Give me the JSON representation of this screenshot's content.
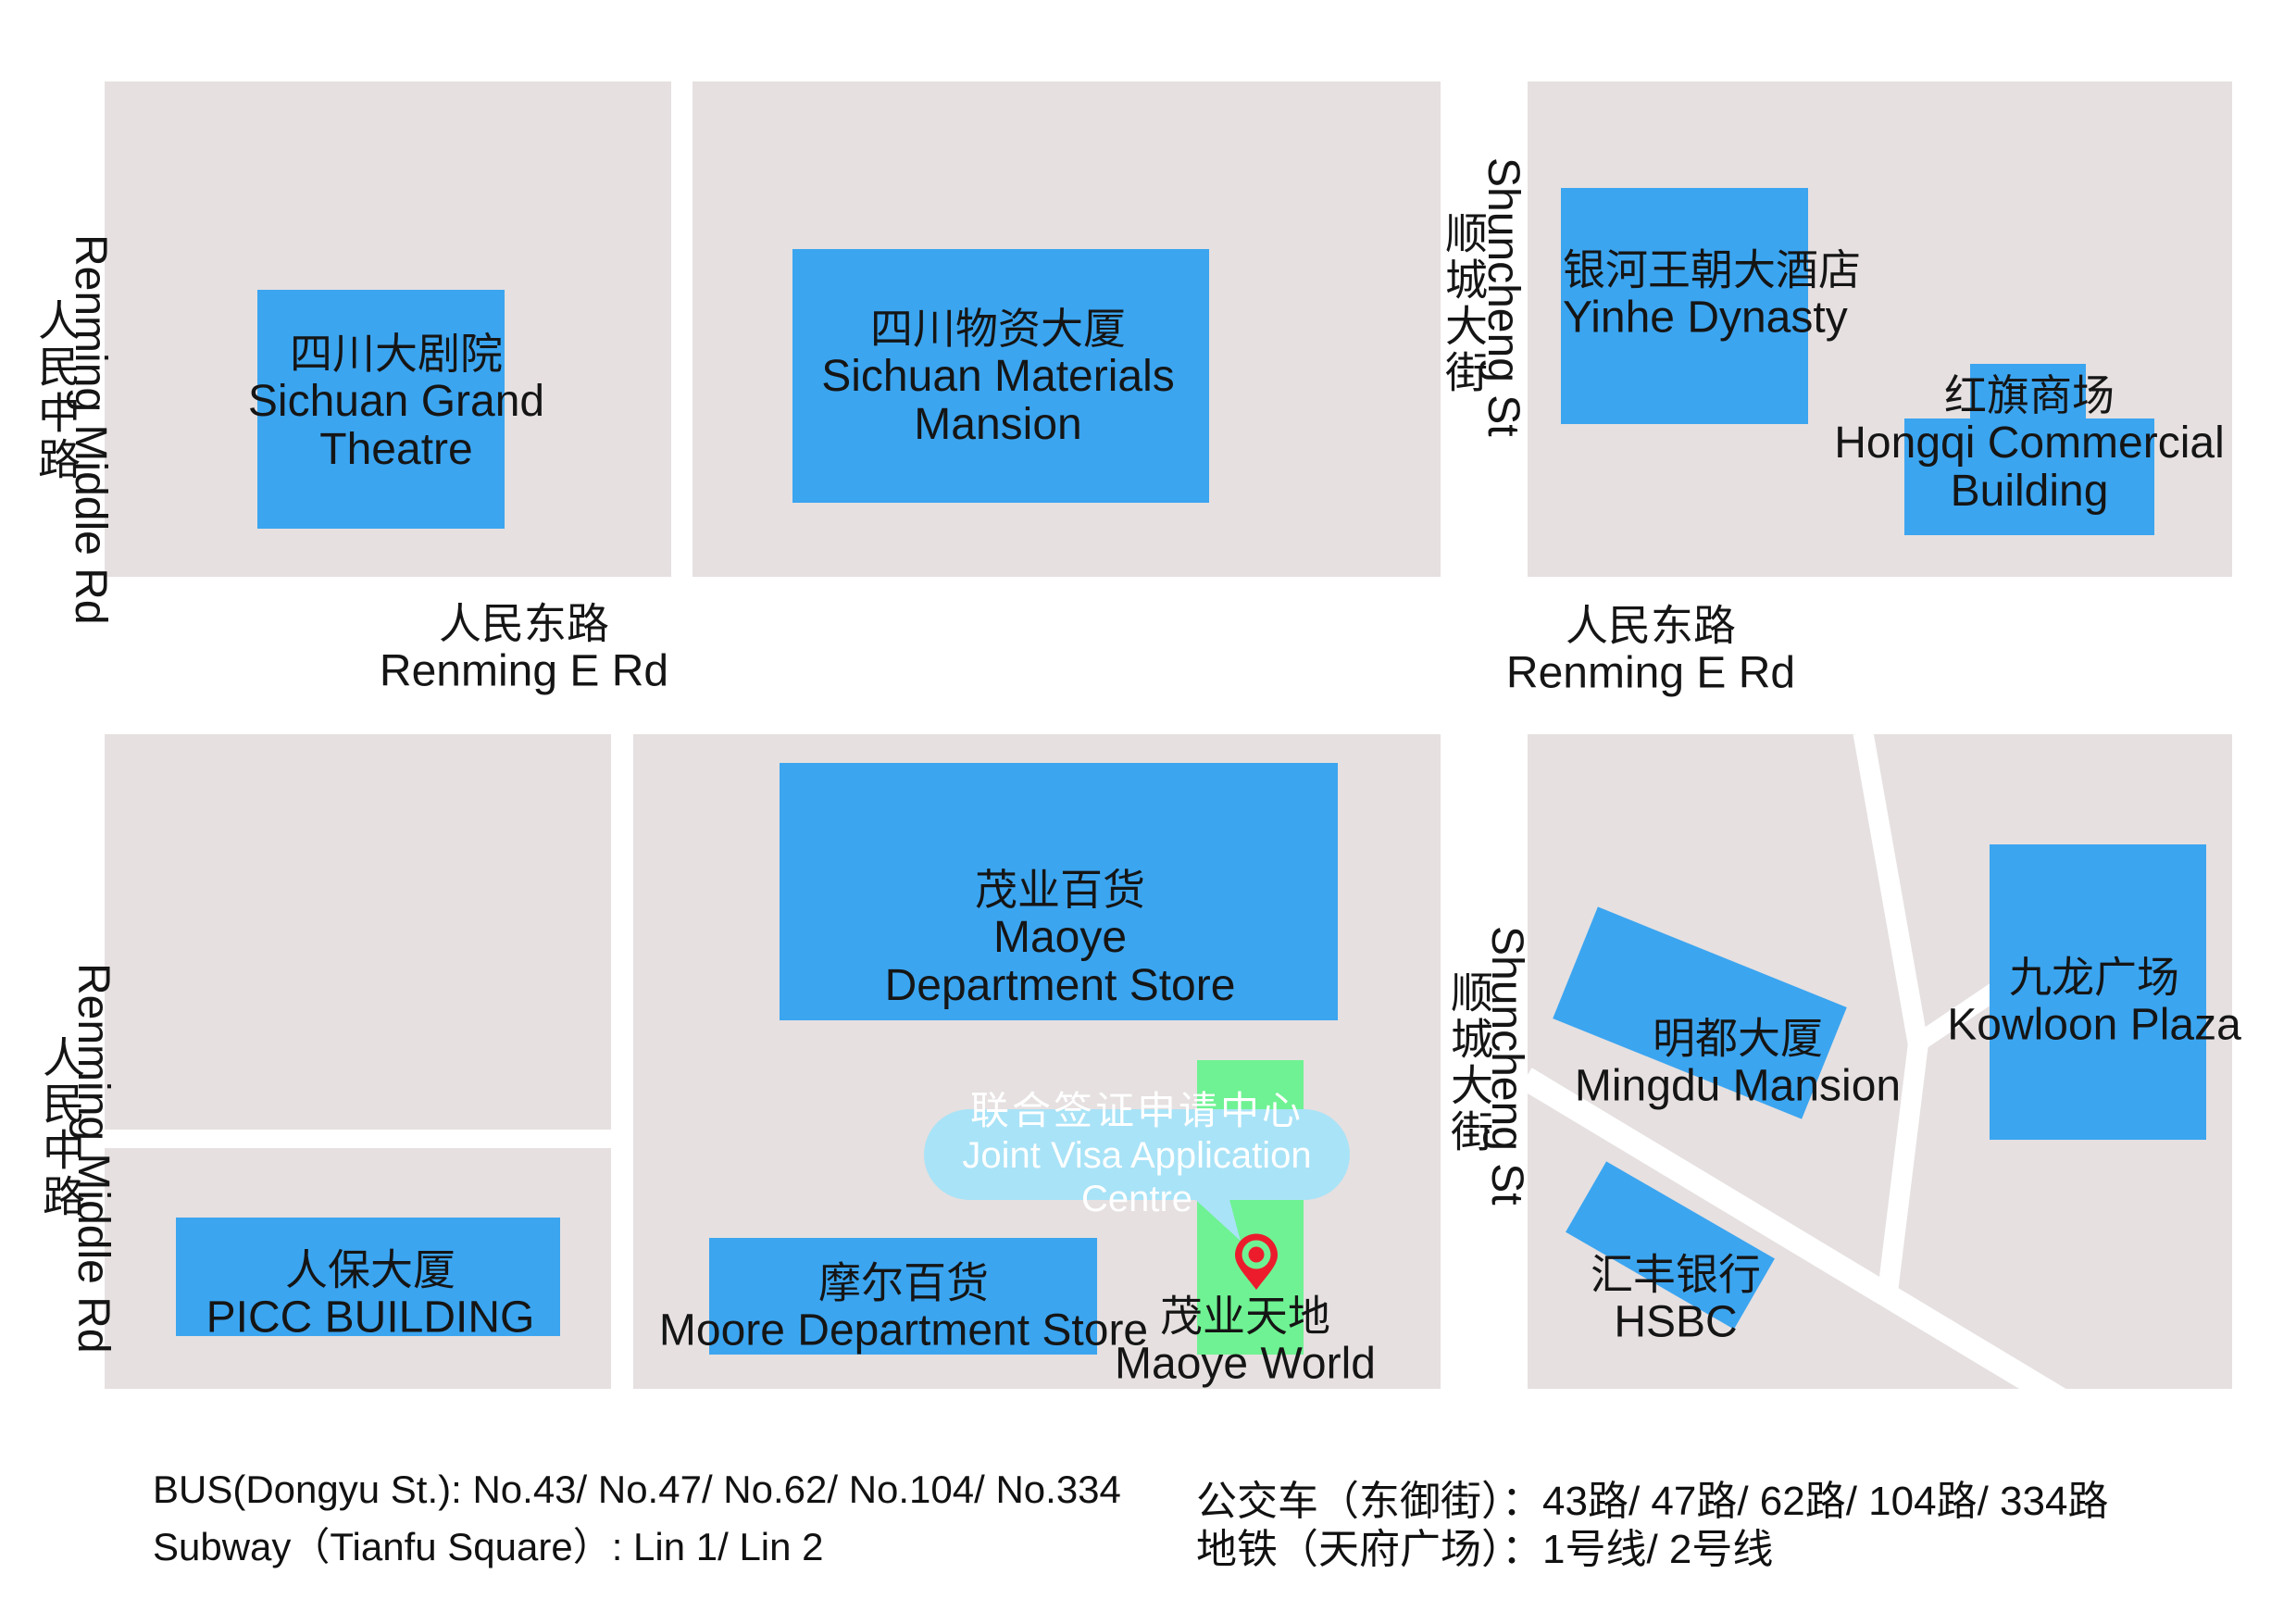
{
  "colors": {
    "building_blue": "#3ba5f0",
    "block_grey": "#e6e0e0",
    "strip_green": "#6ff293",
    "callout_blue": "#a9e3f7",
    "pin_red": "#ec1c2d",
    "road_white": "#ffffff",
    "text_black": "#151515",
    "callout_text": "#ffffff"
  },
  "roads": {
    "renming_middle": {
      "zh": "人民中路",
      "en": "Renming Middle Rd"
    },
    "renming_e": {
      "zh": "人民东路",
      "en": "Renming E Rd"
    },
    "shuncheng": {
      "zh": "顺城大街",
      "en": "Shuncheng St"
    }
  },
  "buildings": {
    "theatre": {
      "zh": "四川大剧院",
      "en1": "Sichuan Grand",
      "en2": "Theatre"
    },
    "materials": {
      "zh": "四川物资大厦",
      "en1": "Sichuan Materials",
      "en2": "Mansion"
    },
    "yinhe": {
      "zh": "银河王朝大酒店",
      "en": "Yinhe Dynasty"
    },
    "hongqi": {
      "zh": "红旗商场",
      "en1": "Hongqi Commercial",
      "en2": "Building"
    },
    "maoye": {
      "zh": "茂业百货",
      "en1": "Maoye",
      "en2": "Department Store"
    },
    "picc": {
      "zh": "人保大厦",
      "en": "PICC BUILDING"
    },
    "moore": {
      "zh": "摩尔百货",
      "en": "Moore Department Store"
    },
    "mingdu": {
      "zh": "明都大厦",
      "en": "Mingdu Mansion"
    },
    "kowloon": {
      "zh": "九龙广场",
      "en": "Kowloon Plaza"
    },
    "hsbc": {
      "zh": "汇丰银行",
      "en": "HSBC"
    },
    "maoye_world": {
      "zh": "茂业天地",
      "en": "Maoye World"
    }
  },
  "poi": {
    "callout": {
      "zh": "联合签证申请中心",
      "en": "Joint Visa Application Centre"
    },
    "pin_icon": "location-pin-icon"
  },
  "footer": {
    "bus_en": "BUS(Dongyu St.): No.43/ No.47/ No.62/ No.104/ No.334",
    "subway_en": "Subway（Tianfu Square）: Lin 1/ Lin 2",
    "bus_zh": "公交车（东御街）：43路/ 47路/ 62路/ 104路/ 334路",
    "subway_zh": "地铁（天府广场）：1号线/ 2号线"
  }
}
